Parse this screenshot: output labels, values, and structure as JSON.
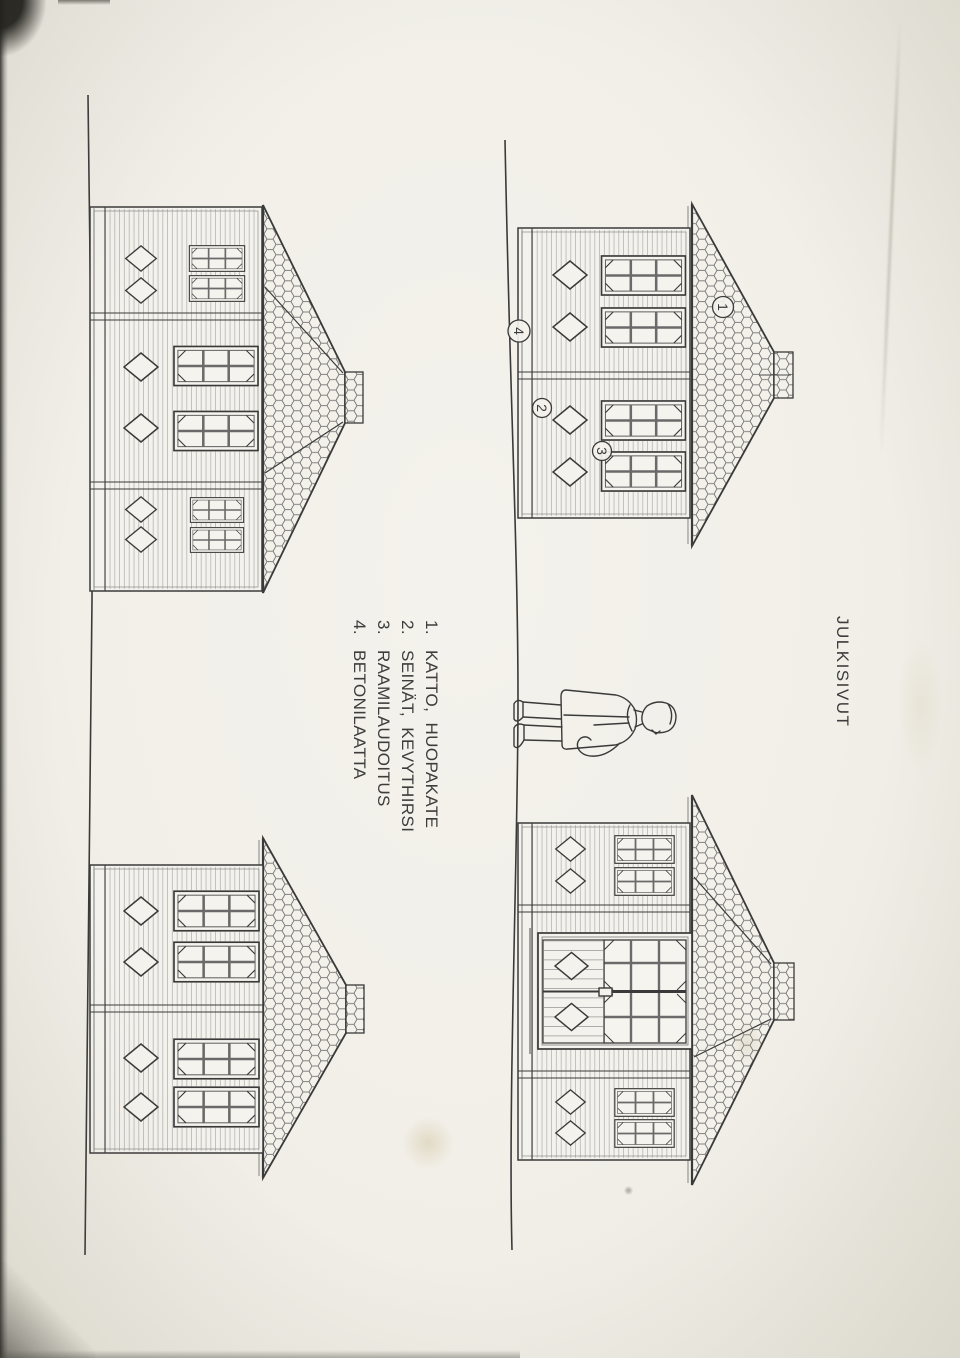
{
  "title": {
    "text": "JULKISIVUT"
  },
  "legend": {
    "items": [
      {
        "number": "1.",
        "text": "KATTO,  HUOPAKATE"
      },
      {
        "number": "2.",
        "text": "SEINÄT,  KEVYTHIRSI"
      },
      {
        "number": "3.",
        "text": "RAAMILAUDOITUS"
      },
      {
        "number": "4.",
        "text": "BETONILAATTA"
      }
    ]
  },
  "markers": [
    {
      "label": "1"
    },
    {
      "label": "2"
    },
    {
      "label": "3"
    },
    {
      "label": "4"
    }
  ],
  "colors": {
    "paper": "#f2f0e9",
    "ink": "#3a3a3a",
    "hatch_gray": "#6f6f6f",
    "siding_gray": "#9a9a9a"
  }
}
